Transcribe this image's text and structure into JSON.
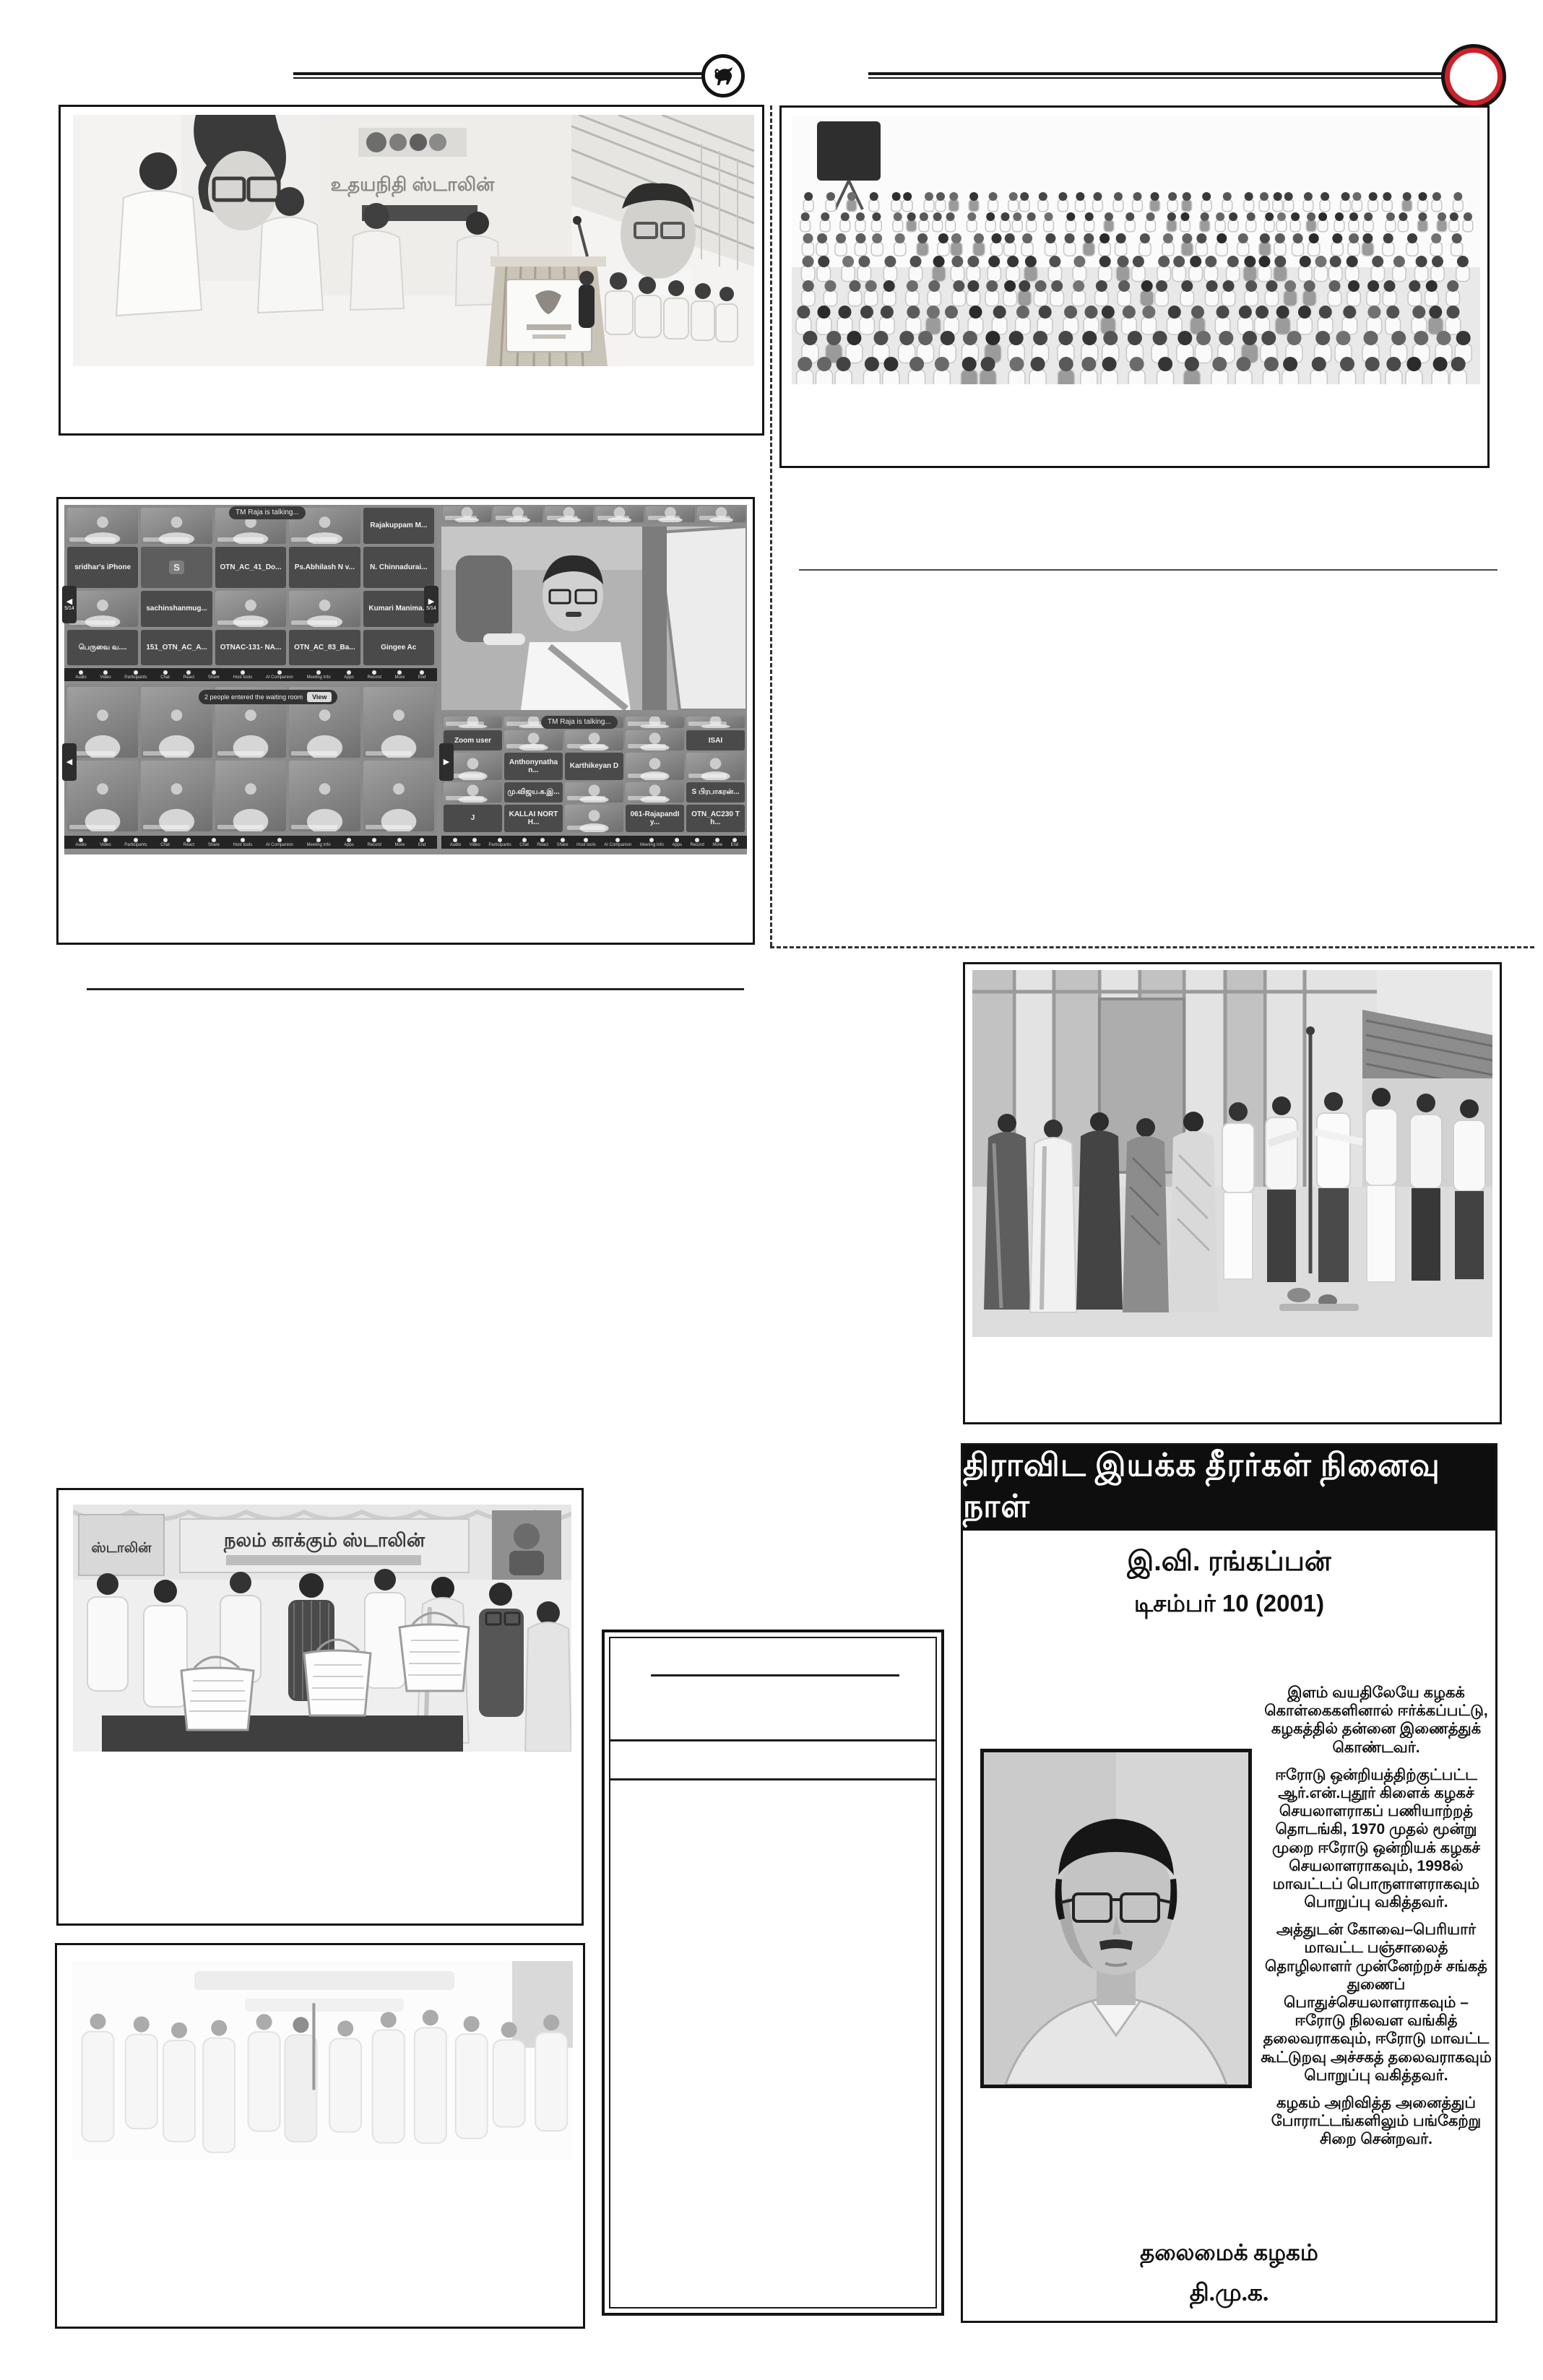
{
  "masthead": {
    "left_emblem": "bull-emblem",
    "right_emblem": "red-ring-emblem",
    "accent_red": "#cd2028"
  },
  "photos": {
    "stage": {
      "description": "Party function: leaders in white shirts beside a wooden podium, large backdrop banner, seated guests and children at right",
      "backdrop_text": "உதயநிதி ஸ்டாலின்"
    },
    "crowd": {
      "description": "Large indoor gathering of seated party cadres in white shirts"
    },
    "montage": {
      "description": "Composite of Zoom video-conference screenshots of party functionaries"
    },
    "outdoor": {
      "description": "Members with women in saris at a flag-post ceremony in front of a building"
    },
    "baskets": {
      "description": "Distribution of welfare kits in white plastic baskets under a decorated banner",
      "banner_text": "நலம் காக்கும் ஸ்டாலின்",
      "poster_text": "ஸ்டாலின்"
    },
    "faded": {
      "description": "Faded group photograph of party members at an indoor event"
    }
  },
  "montage": {
    "toast": "TM Raja is talking...",
    "waiting_note": "2 people entered the waiting room",
    "waiting_action": "View",
    "page_indicator": "5/14",
    "toolbar": [
      "Audio",
      "Video",
      "Participants",
      "Chat",
      "React",
      "Share",
      "Host tools",
      "AI Companion",
      "Meeting Info",
      "Apps",
      "Record",
      "More",
      "End"
    ],
    "gallery_top_left": {
      "cols": 5,
      "tiles": [
        {
          "t": "v",
          "l": ""
        },
        {
          "t": "v",
          "l": ""
        },
        {
          "t": "v",
          "l": ""
        },
        {
          "t": "v",
          "l": ""
        },
        {
          "t": "n",
          "l": "Rajakuppam M..."
        },
        {
          "t": "n",
          "l": "sridhar's iPhone"
        },
        {
          "t": "a",
          "l": "S"
        },
        {
          "t": "n",
          "l": "OTN_AC_41_Do..."
        },
        {
          "t": "n",
          "l": "Ps.Abhilash N v..."
        },
        {
          "t": "n",
          "l": "N. Chinnadurai..."
        },
        {
          "t": "v",
          "l": ""
        },
        {
          "t": "n",
          "l": "sachinshanmug..."
        },
        {
          "t": "v",
          "l": ""
        },
        {
          "t": "v",
          "l": ""
        },
        {
          "t": "n",
          "l": "Kumari Manima..."
        },
        {
          "t": "n",
          "l": "பெருவை வ...."
        },
        {
          "t": "n",
          "l": "151_OTN_AC_A..."
        },
        {
          "t": "n",
          "l": "OTNAC-131- NA..."
        },
        {
          "t": "n",
          "l": "OTN_AC_83_Ba..."
        },
        {
          "t": "n",
          "l": "Gingee Ac"
        }
      ]
    },
    "gallery_bottom_left": {
      "cols": 5,
      "tiles": [
        {
          "t": "v",
          "l": ""
        },
        {
          "t": "v",
          "l": ""
        },
        {
          "t": "v",
          "l": ""
        },
        {
          "t": "v",
          "l": ""
        },
        {
          "t": "v",
          "l": ""
        },
        {
          "t": "v",
          "l": ""
        },
        {
          "t": "v",
          "l": ""
        },
        {
          "t": "v",
          "l": ""
        },
        {
          "t": "v",
          "l": ""
        },
        {
          "t": "v",
          "l": ""
        }
      ]
    },
    "strip_top_right": {
      "cols": 6,
      "tiles": [
        {
          "t": "v",
          "l": ""
        },
        {
          "t": "v",
          "l": ""
        },
        {
          "t": "v",
          "l": ""
        },
        {
          "t": "v",
          "l": ""
        },
        {
          "t": "v",
          "l": ""
        },
        {
          "t": "v",
          "l": ""
        }
      ]
    },
    "gallery_bottom_right": {
      "cols": 5,
      "tiles": [
        {
          "t": "v",
          "l": ""
        },
        {
          "t": "v",
          "l": ""
        },
        {
          "t": "v",
          "l": ""
        },
        {
          "t": "v",
          "l": ""
        },
        {
          "t": "v",
          "l": ""
        },
        {
          "t": "n",
          "l": "Zoom user"
        },
        {
          "t": "v",
          "l": ""
        },
        {
          "t": "v",
          "l": ""
        },
        {
          "t": "v",
          "l": ""
        },
        {
          "t": "n",
          "l": "ISAI"
        },
        {
          "t": "v",
          "l": ""
        },
        {
          "t": "n",
          "l": "Anthonynathan..."
        },
        {
          "t": "n",
          "l": "Karthikeyan D"
        },
        {
          "t": "v",
          "l": ""
        },
        {
          "t": "v",
          "l": ""
        },
        {
          "t": "v",
          "l": ""
        },
        {
          "t": "n",
          "l": "மு.விஜய.க.இ..."
        },
        {
          "t": "v",
          "l": ""
        },
        {
          "t": "v",
          "l": ""
        },
        {
          "t": "n",
          "l": "S பிரபாகரன்..."
        },
        {
          "t": "n",
          "l": "J"
        },
        {
          "t": "n",
          "l": "KALLAI NORTH..."
        },
        {
          "t": "v",
          "l": ""
        },
        {
          "t": "n",
          "l": "061-RajapandIy..."
        },
        {
          "t": "n",
          "l": "OTN_AC230 Th..."
        }
      ]
    }
  },
  "memorial": {
    "header": "திராவிட இயக்க தீரர்கள் நினைவு நாள்",
    "name": "இ.வி. ரங்கப்பன்",
    "date": "டிசம்பர் 10  (2001)",
    "paragraphs": [
      "இளம் வயதிலேயே கழகக் கொள்கைகளினால் ஈர்க்கப்பட்டு, கழகத்தில் தன்னை இணைத்துக் கொண்டவர்.",
      "ஈரோடு ஒன்றியத்திற்குட்பட்ட ஆர்.என்.புதூர் கிளைக் கழகச் செயலாளராகப் பணியாற்றத் தொடங்கி, 1970 முதல் மூன்று முறை ஈரோடு ஒன்றியக் கழகச் செயலாளராகவும், 1998ல் மாவட்டப் பொருளாளராகவும் பொறுப்பு வகித்தவர்.",
      "அத்துடன் கோவை–பெரியார் மாவட்ட பஞ்சாலைத் தொழிலாளர் முன்னேற்றச் சங்கத் துணைப் பொதுச்செயலாளராகவும் – ஈரோடு நிலவள வங்கித் தலைவராகவும், ஈரோடு மாவட்ட கூட்டுறவு அச்சகத் தலைவராகவும் பொறுப்பு வகித்தவர்.",
      "கழகம் அறிவித்த அனைத்துப் போராட்டங்களிலும் பங்கேற்று சிறை சென்றவர்."
    ],
    "footer_org": "தலைமைக் கழகம்",
    "footer_party": "தி.மு.க."
  }
}
